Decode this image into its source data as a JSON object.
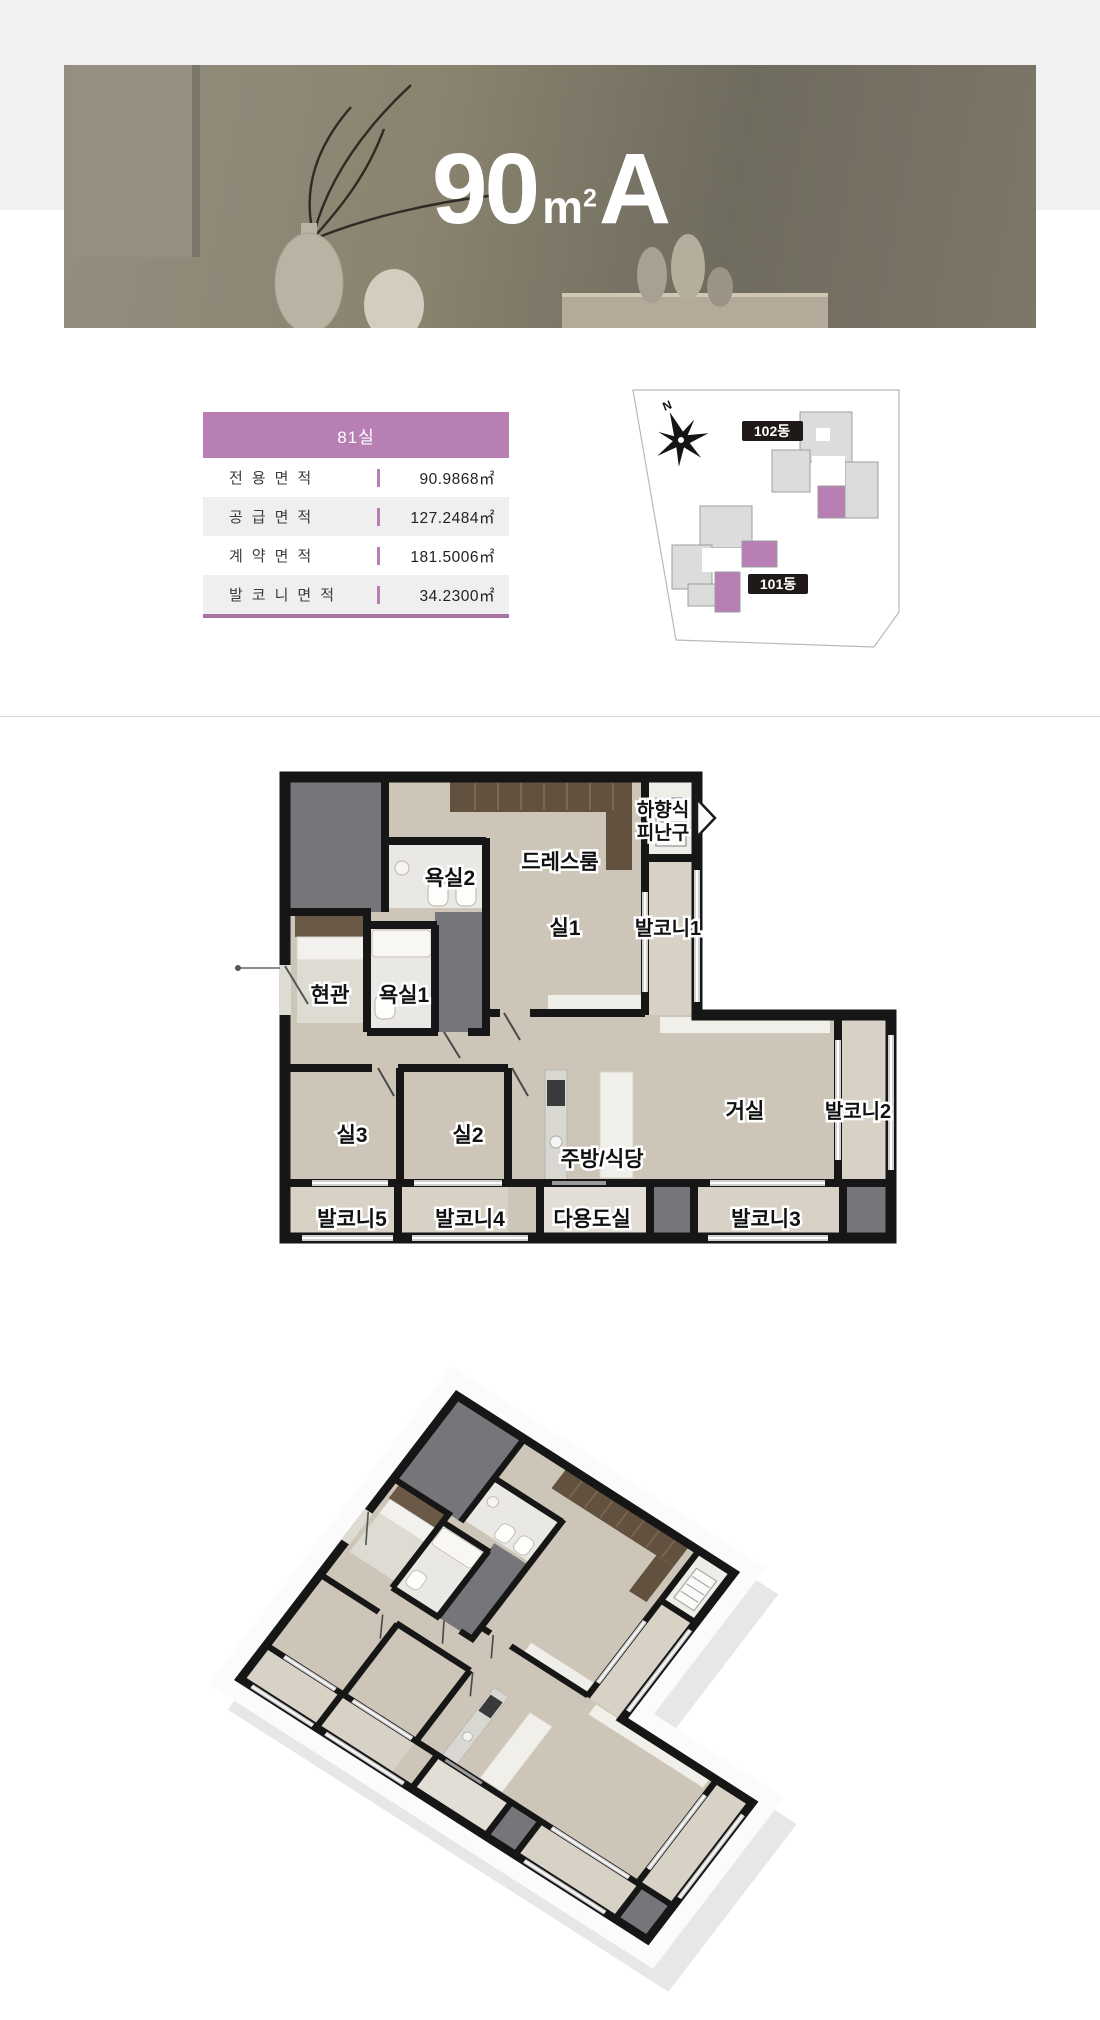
{
  "banner": {
    "title": "90㎡A",
    "title_parts": {
      "number": "90",
      "unit_base": "m",
      "unit_sup": "2",
      "variant": "A"
    }
  },
  "info_table": {
    "header": "81실",
    "rows": [
      {
        "label": "전용면적",
        "value": "90.9868㎡"
      },
      {
        "label": "공급면적",
        "value": "127.2484㎡"
      },
      {
        "label": "계약면적",
        "value": "181.5006㎡"
      },
      {
        "label": "발코니면적",
        "value": "34.2300㎡"
      }
    ],
    "accent_color": "#b77fb4"
  },
  "site_map": {
    "north_label": "N",
    "buildings": [
      {
        "label": "102동"
      },
      {
        "label": "101동"
      }
    ],
    "highlight_color": "#b77fb4"
  },
  "floor_plan": {
    "escape_hatch": {
      "line1": "하향식",
      "line2": "피난구"
    },
    "rooms": [
      {
        "label": "드레스룸"
      },
      {
        "label": "욕실2"
      },
      {
        "label": "실1"
      },
      {
        "label": "발코니1"
      },
      {
        "label": "현관"
      },
      {
        "label": "욕실1"
      },
      {
        "label": "실3"
      },
      {
        "label": "실2"
      },
      {
        "label": "주방/식당"
      },
      {
        "label": "거실"
      },
      {
        "label": "발코니2"
      },
      {
        "label": "발코니5"
      },
      {
        "label": "발코니4"
      },
      {
        "label": "다용도실"
      },
      {
        "label": "발코니3"
      }
    ]
  }
}
